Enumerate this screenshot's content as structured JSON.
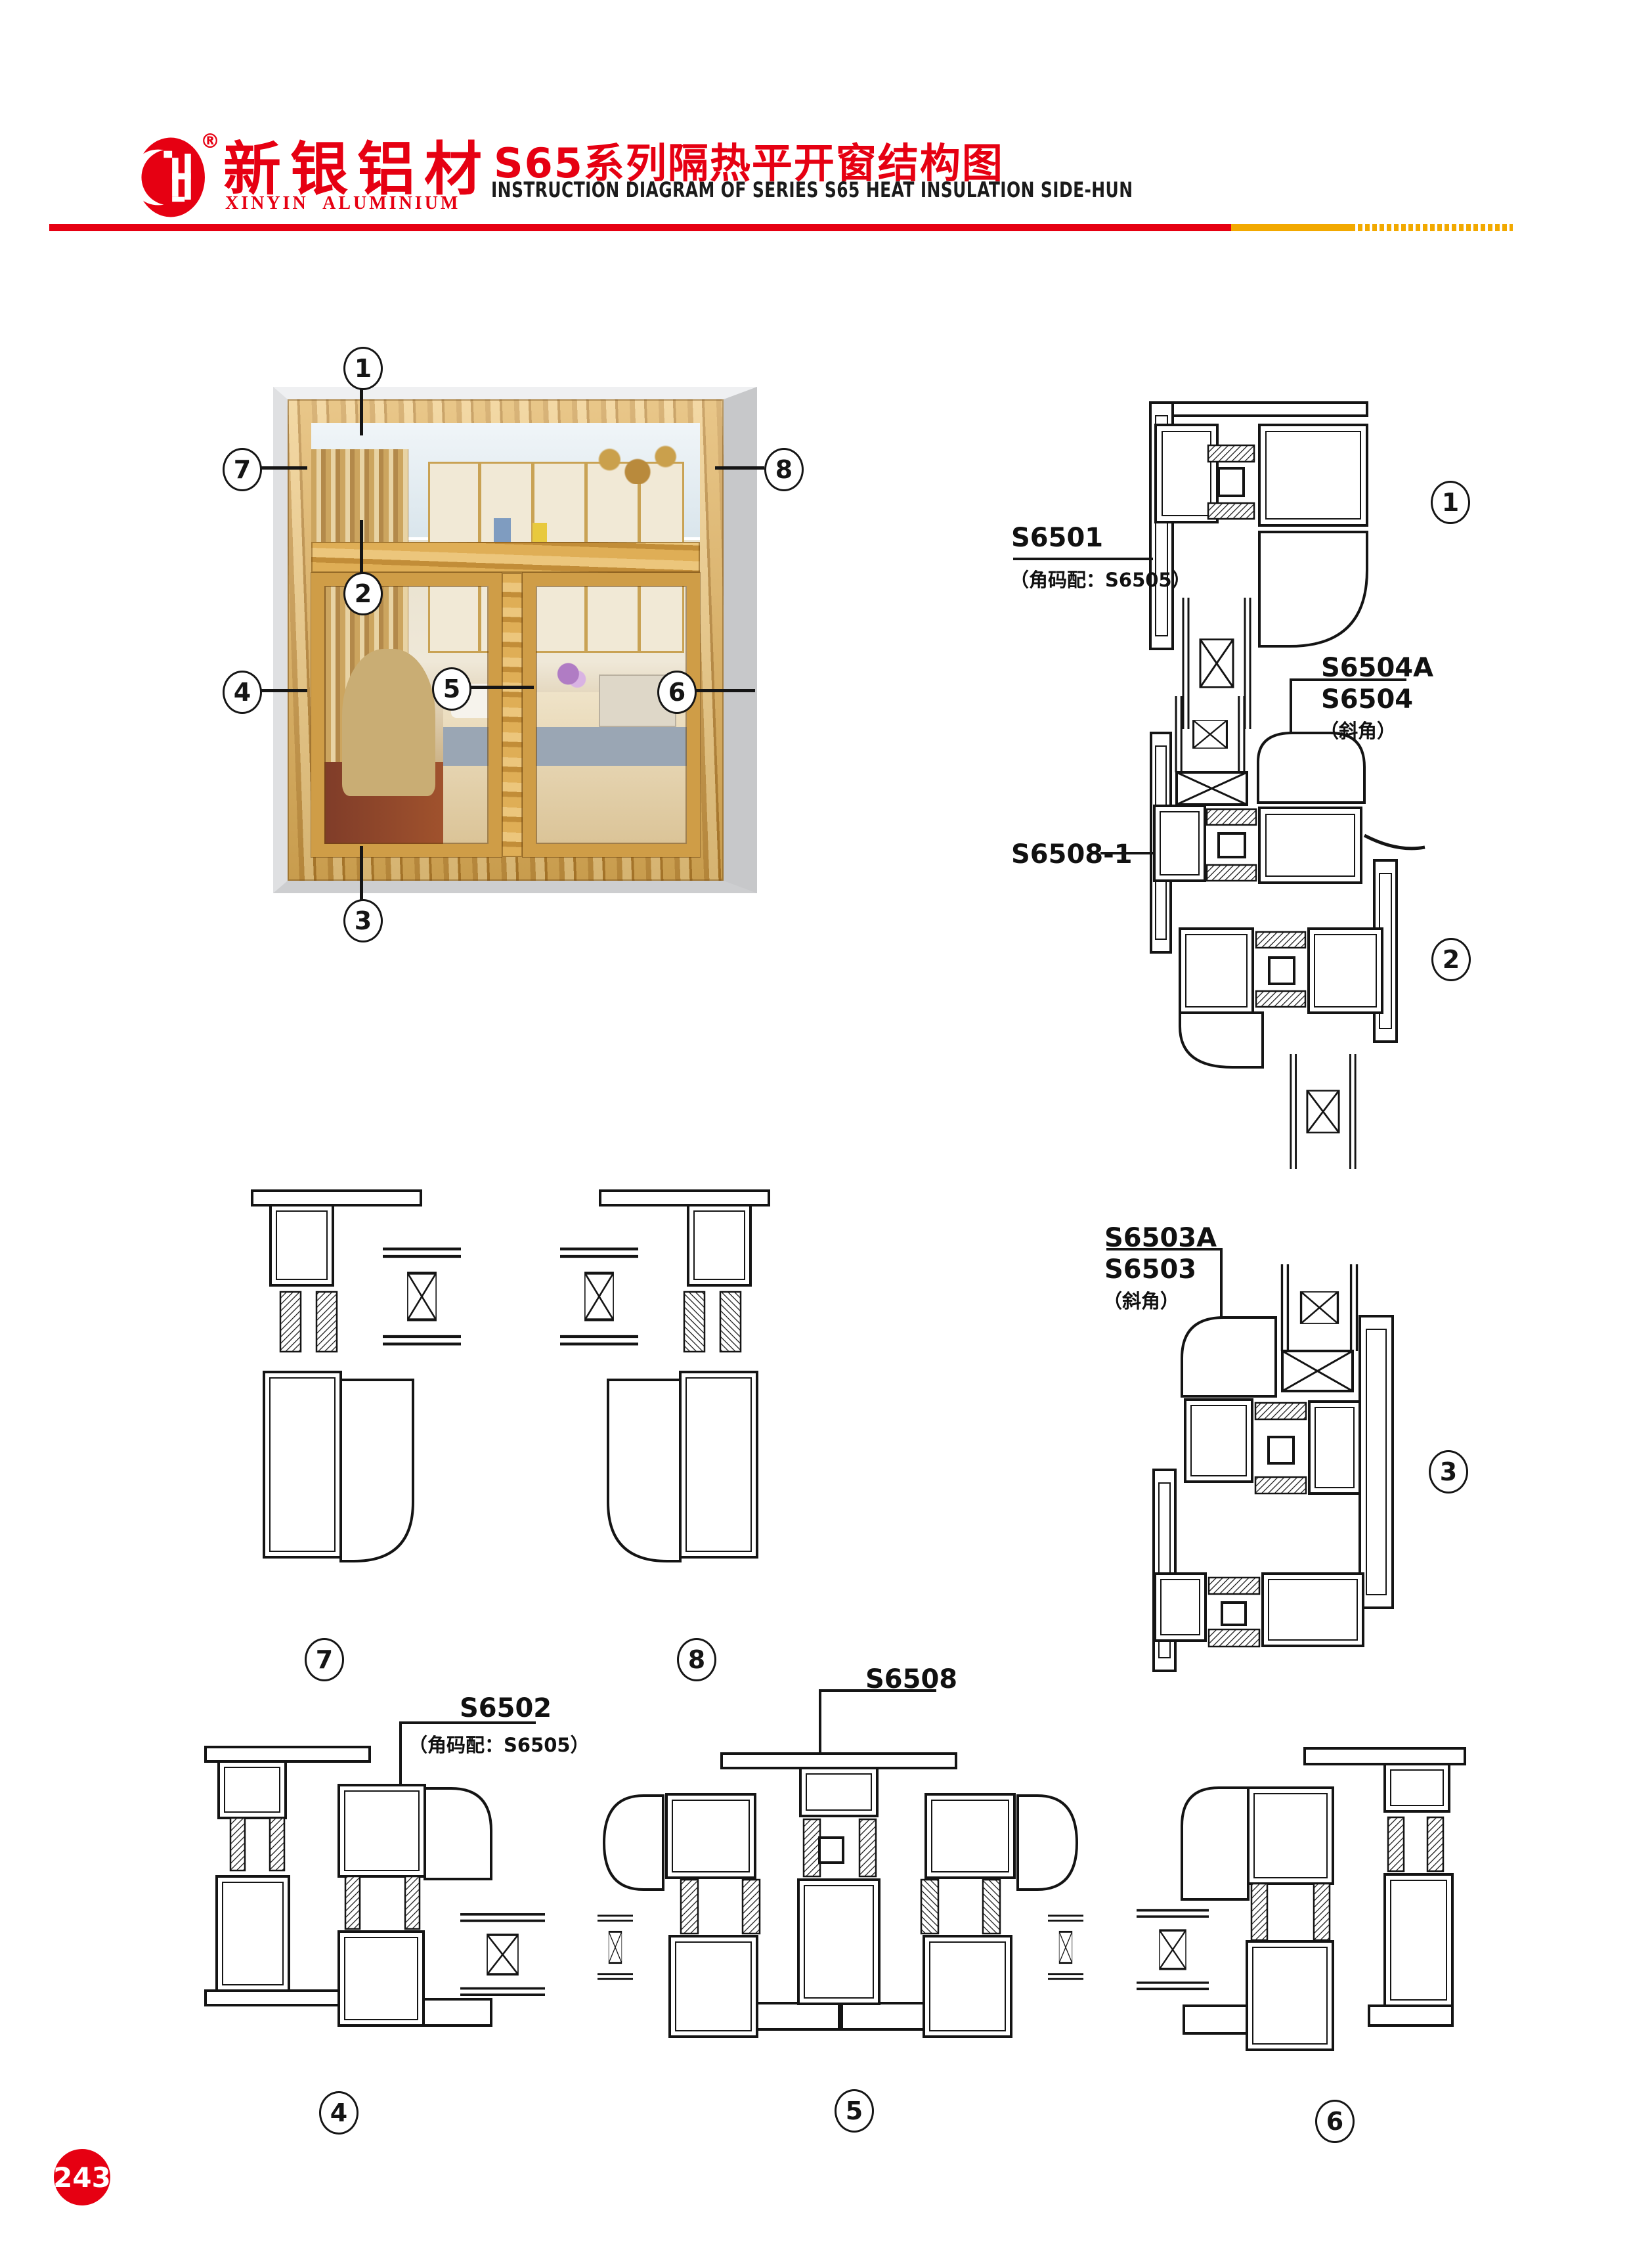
{
  "page": {
    "number": "243"
  },
  "header": {
    "brand_cn": "新银铝材",
    "brand_en": "XINYIN ALUMINIUM",
    "reg_mark": "®",
    "title_cn": "S65系列隔热平开窗结构图",
    "title_en": "INSTRUCTION DIAGRAM OF SERIES S65 HEAT INSULATION SIDE-HUN"
  },
  "colors": {
    "red": "#e60012",
    "yellow": "#f2a900",
    "line": "#151515",
    "wood": "#cf9d47"
  },
  "window": {
    "callouts": {
      "c1": "1",
      "c2": "2",
      "c3": "3",
      "c4": "4",
      "c5": "5",
      "c6": "6",
      "c7": "7",
      "c8": "8"
    }
  },
  "details": {
    "d1": {
      "callout": "1",
      "label": "S6501",
      "sub": "（角码配：S6505）"
    },
    "d2": {
      "callout": "2",
      "label_a": "S6504A",
      "label_b": "S6504",
      "label_c": "（斜角）",
      "label_left": "S6508-1"
    },
    "d3": {
      "callout": "3",
      "label_a": "S6503A",
      "label_b": "S6503",
      "label_c": "（斜角）"
    },
    "d4": {
      "callout": "4",
      "label": "S6502",
      "sub": "（角码配：S6505）"
    },
    "d5": {
      "callout": "5",
      "label": "S6508"
    },
    "d6": {
      "callout": "6"
    },
    "d7": {
      "callout": "7"
    },
    "d8": {
      "callout": "8"
    }
  }
}
